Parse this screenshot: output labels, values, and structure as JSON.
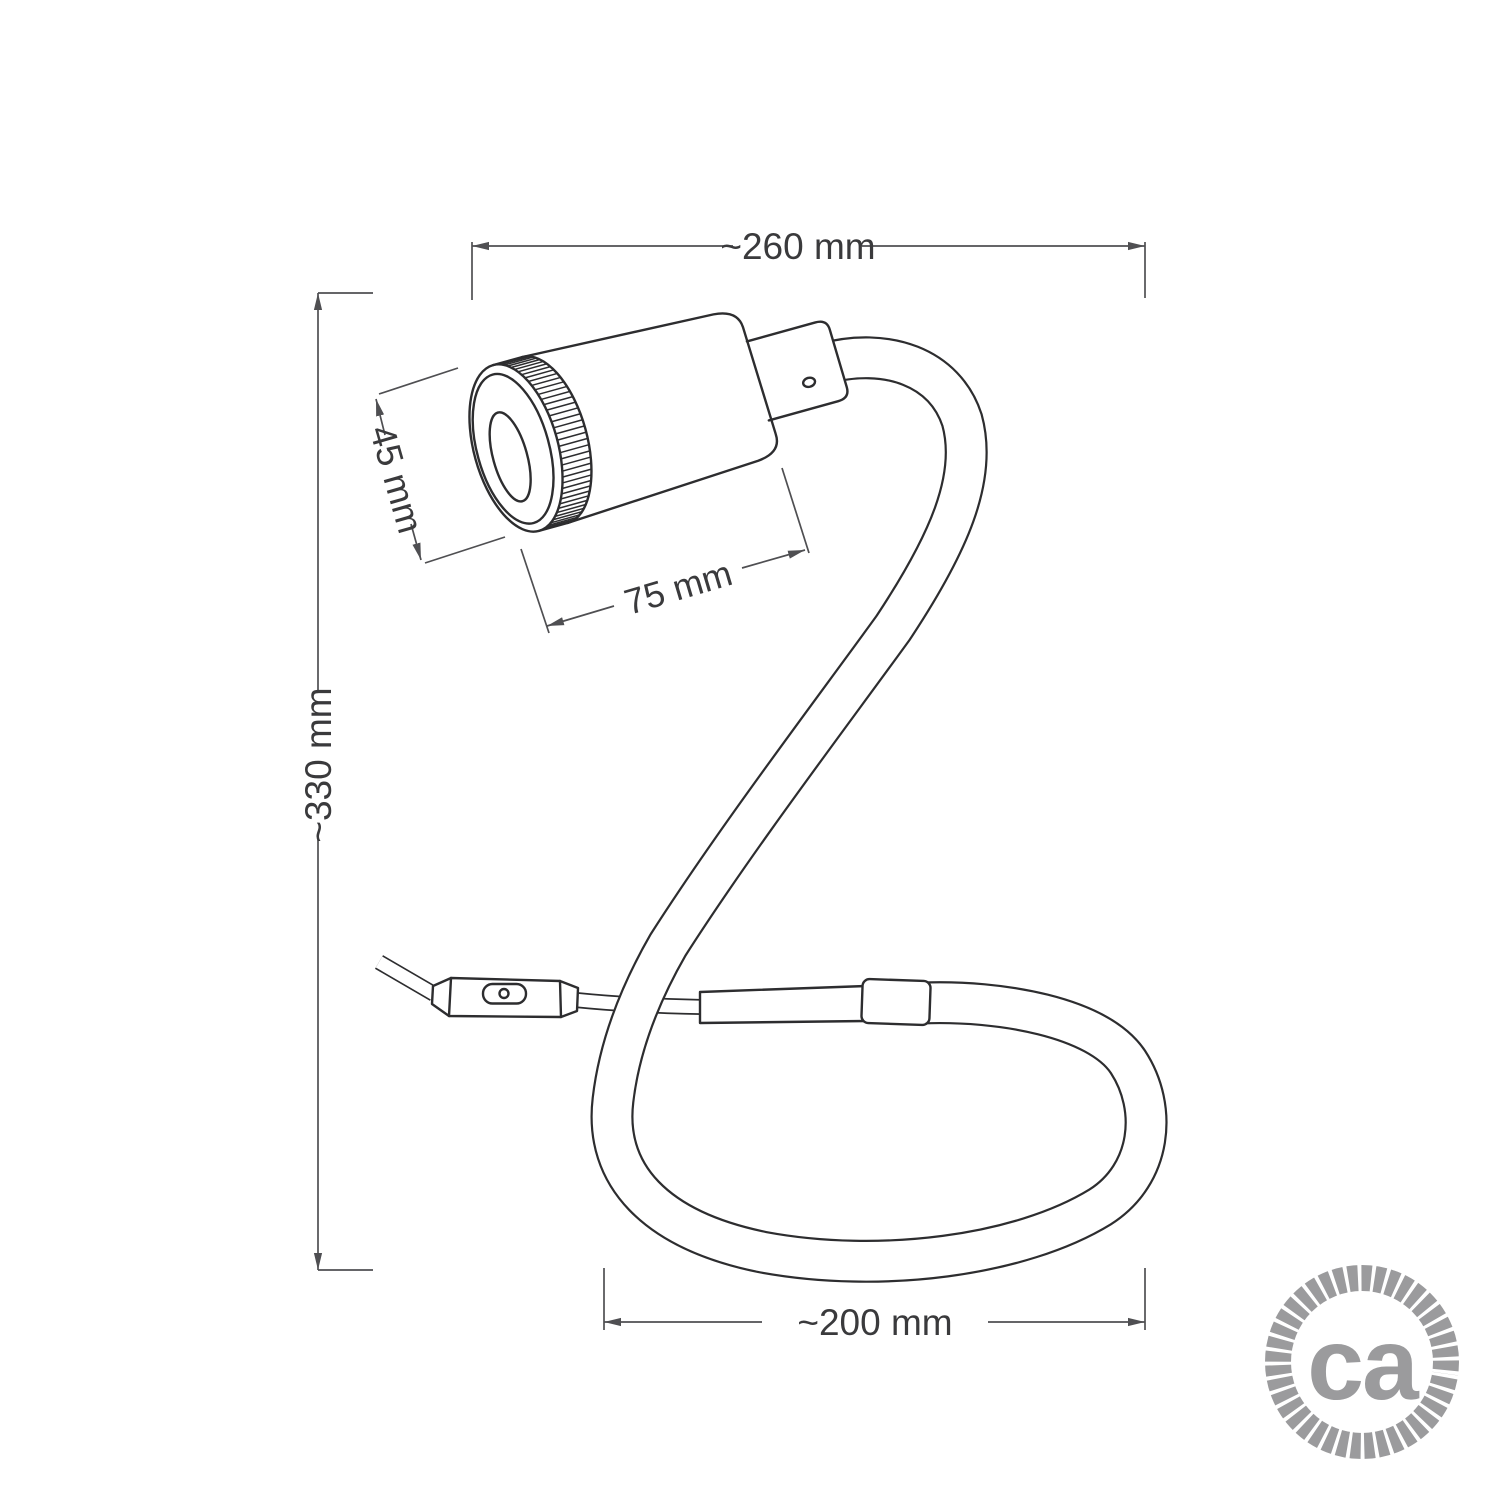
{
  "dimensions": {
    "width": "~260 mm",
    "height": "~330 mm",
    "spot_diameter": "45 mm",
    "spot_length": "75 mm",
    "base_width": "~200 mm"
  },
  "logo": {
    "text": "ca"
  },
  "colors": {
    "line": "#2d2d2f",
    "dimension": "#4f4f52",
    "text": "#3a3a3c",
    "logo_gray": "#9b9b9d",
    "background": "#ffffff"
  }
}
